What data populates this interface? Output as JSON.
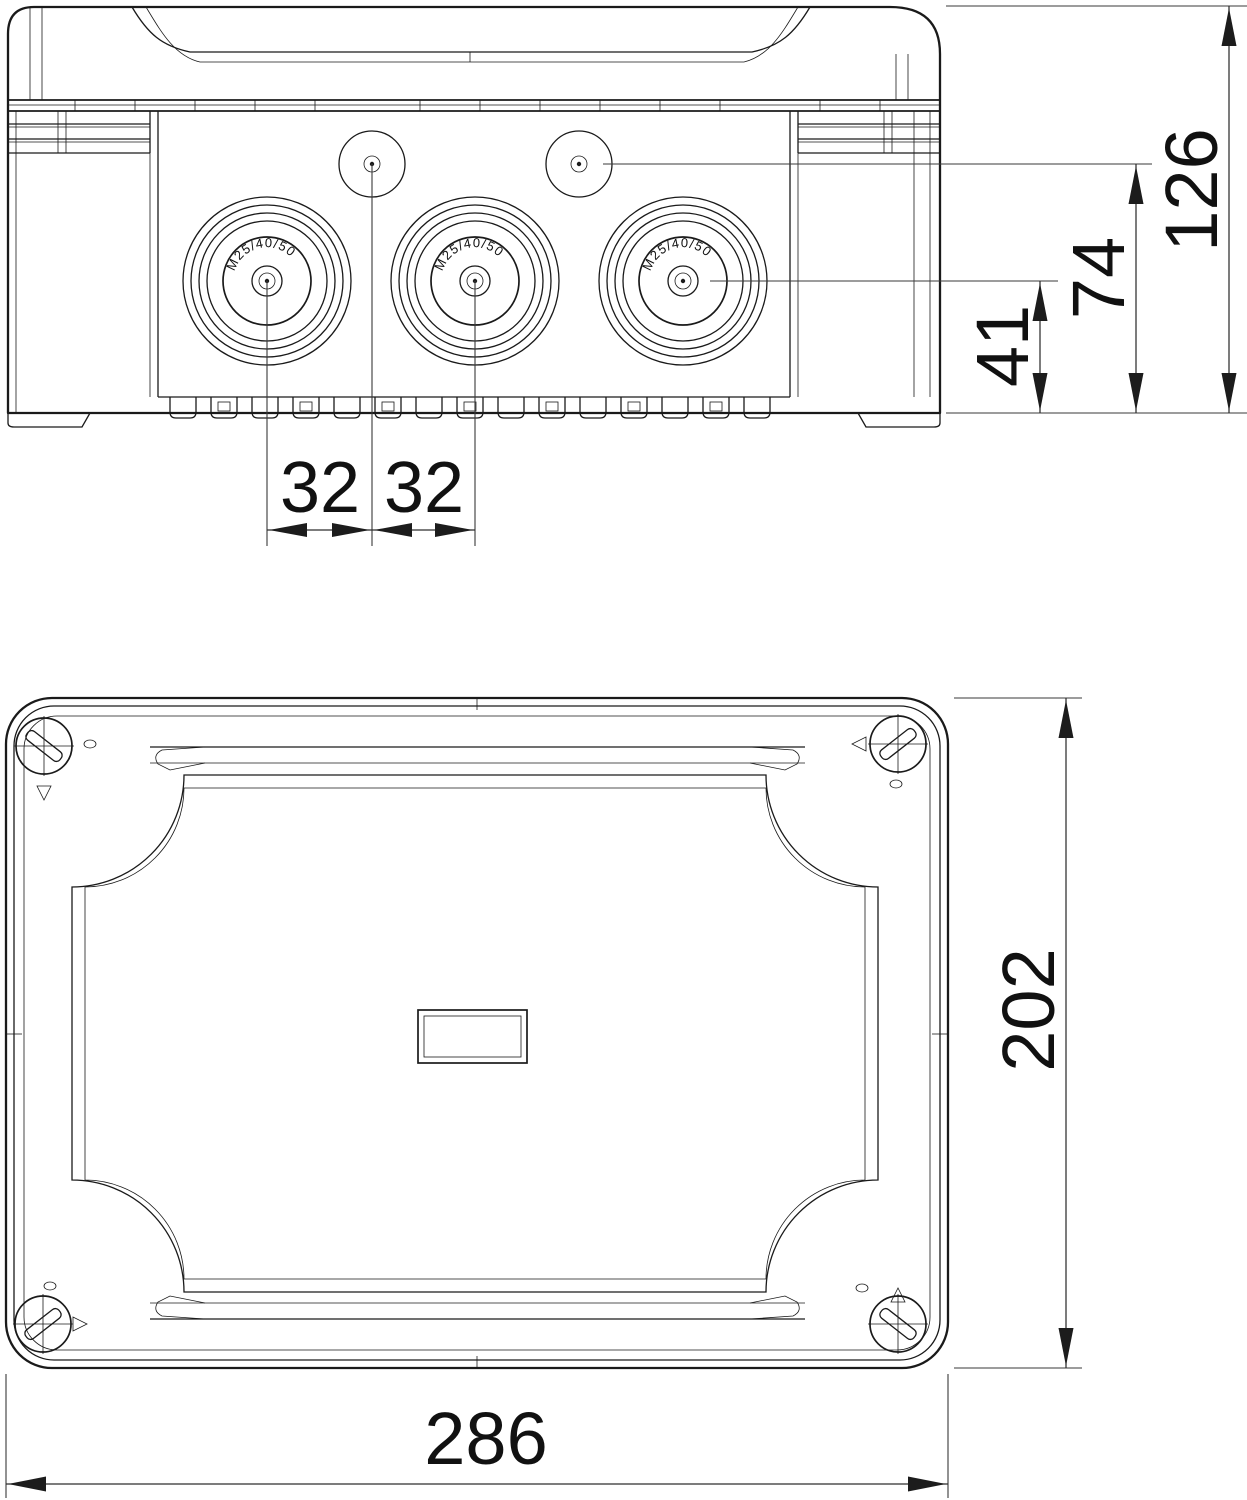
{
  "drawing": {
    "side_view": {
      "gland_label": "M25/40/50",
      "dims": {
        "pitch_left": "32",
        "pitch_right": "32",
        "gland_height": "41",
        "knockout_height": "74",
        "total_height": "126"
      }
    },
    "plan_view": {
      "dims": {
        "width": "286",
        "depth": "202"
      }
    }
  }
}
